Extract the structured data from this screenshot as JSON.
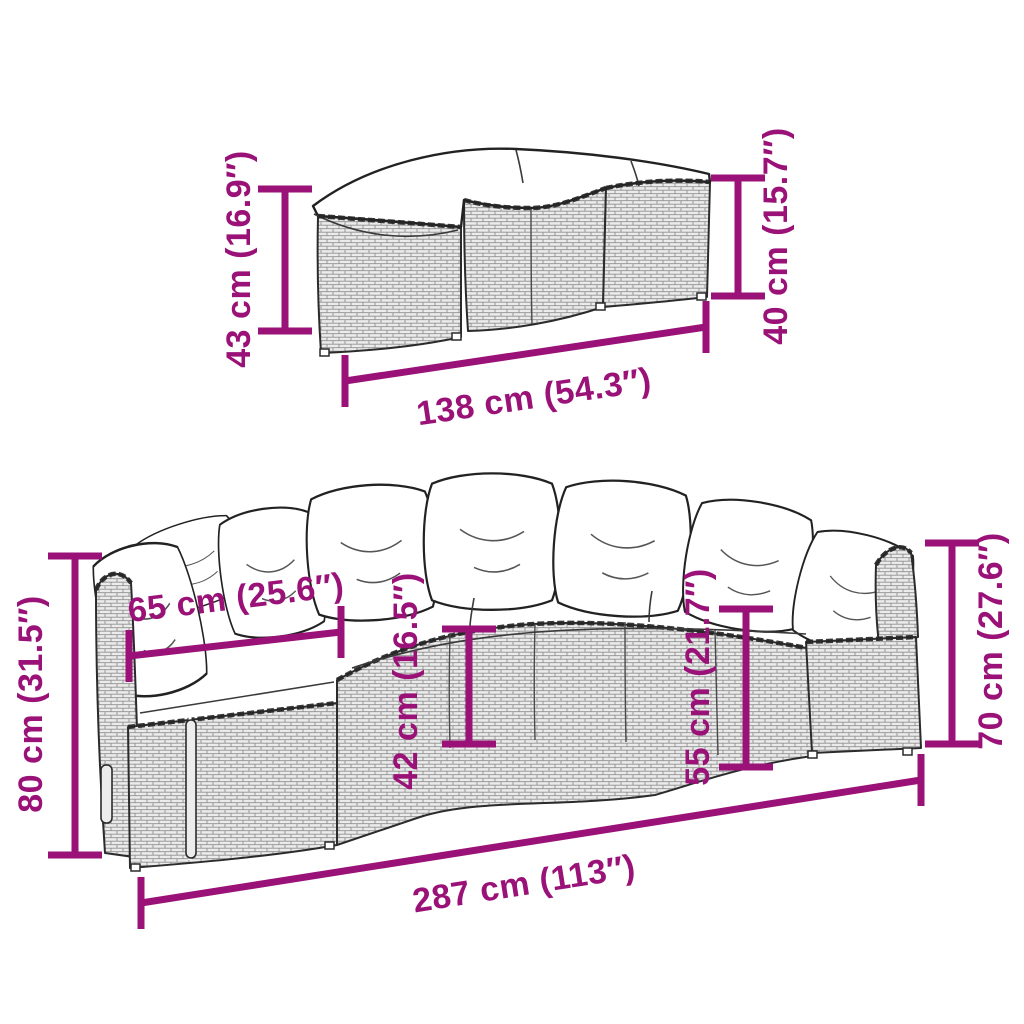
{
  "accent_color": "#9A1277",
  "outline_color": "#2B2B2B",
  "top_module": {
    "height_left": "43 cm (16.9″)",
    "height_right": "40 cm (15.7″)",
    "width": "138 cm (54.3″)"
  },
  "sofa": {
    "total_height": "80 cm (31.5″)",
    "seat_depth": "65 cm (25.6″)",
    "seat_height": "42 cm (16.5″)",
    "cushion_top_height": "55 cm (21.7″)",
    "back_height": "70 cm (27.6″)",
    "total_width": "287 cm (113″)"
  }
}
